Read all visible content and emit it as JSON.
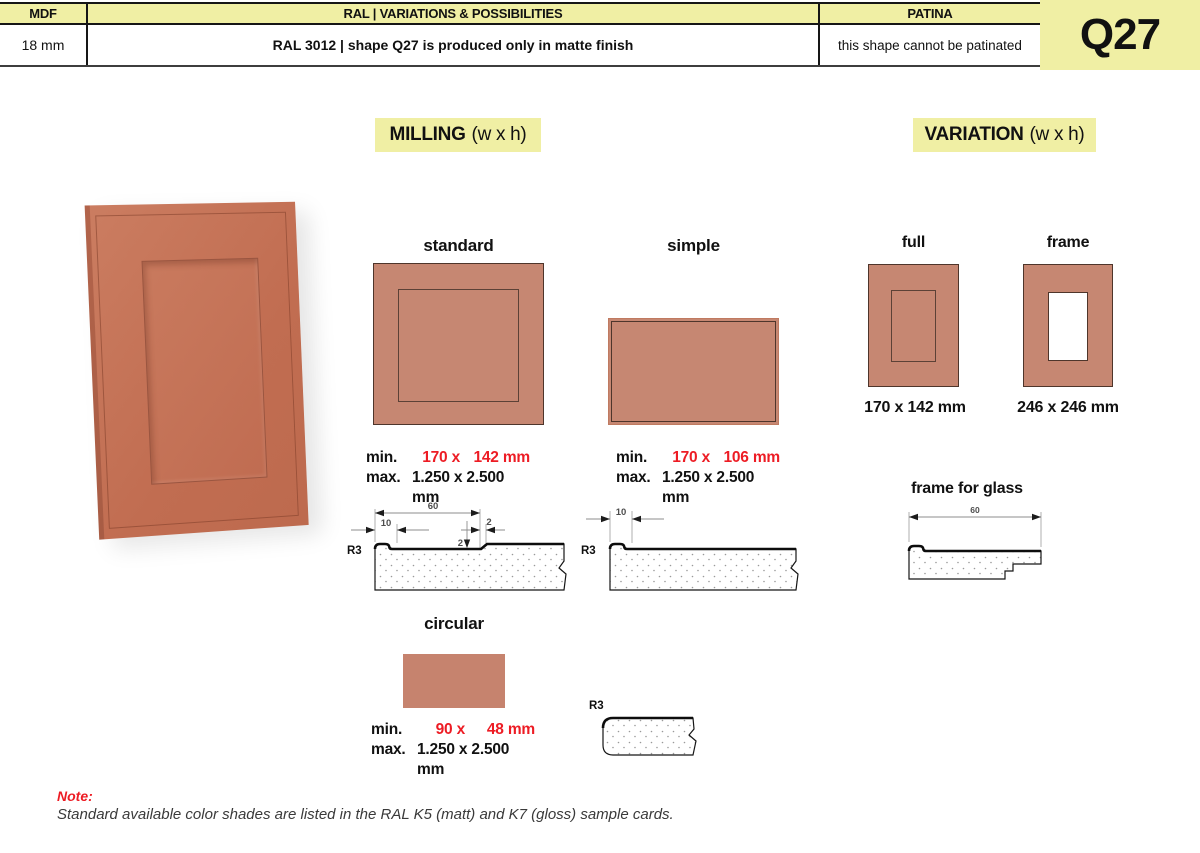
{
  "header": {
    "cols": [
      {
        "label": "MDF",
        "value": "18 mm"
      },
      {
        "label": "RAL | VARIATIONS & POSSIBILITIES",
        "value": "RAL 3012 | shape Q27 is produced only in matte finish"
      },
      {
        "label": "PATINA",
        "value": "this shape cannot be patinated"
      }
    ],
    "shape_code": "Q27"
  },
  "section_titles": {
    "milling": "MILLING",
    "milling_suffix": "(w x h)",
    "variation": "VARIATION",
    "variation_suffix": "(w x h)"
  },
  "milling": {
    "standard": {
      "label": "standard",
      "min_label": "min.",
      "min_w": "170 x",
      "min_h": "142 mm",
      "max_label": "max.",
      "max_value": "1.250 x 2.500 mm",
      "profile": {
        "width": "60",
        "lip": "10",
        "step_w": "2",
        "step_d": "2",
        "radius": "R3"
      }
    },
    "simple": {
      "label": "simple",
      "min_label": "min.",
      "min_w": "170 x",
      "min_h": "106 mm",
      "max_label": "max.",
      "max_value": "1.250 x 2.500 mm",
      "profile": {
        "lip": "10",
        "radius": "R3"
      }
    },
    "circular": {
      "label": "circular",
      "min_label": "min.",
      "min_w": "90 x",
      "min_h": "48 mm",
      "max_label": "max.",
      "max_value": "1.250 x 2.500 mm",
      "profile": {
        "radius": "R3"
      }
    }
  },
  "variation": {
    "full": {
      "label": "full",
      "size": "170 x 142 mm"
    },
    "frame": {
      "label": "frame",
      "size": "246 x 246 mm"
    },
    "frame_for_glass": {
      "label": "frame for glass",
      "profile": {
        "width": "60"
      }
    }
  },
  "note": {
    "label": "Note:",
    "text": "Standard available color shades are listed in the RAL K5 (matt) and K7 (gloss) sample cards."
  },
  "colors": {
    "accent_yellow": "#f0efa4",
    "panel_fill": "#c68772",
    "highlight_red": "#ed1c24"
  }
}
